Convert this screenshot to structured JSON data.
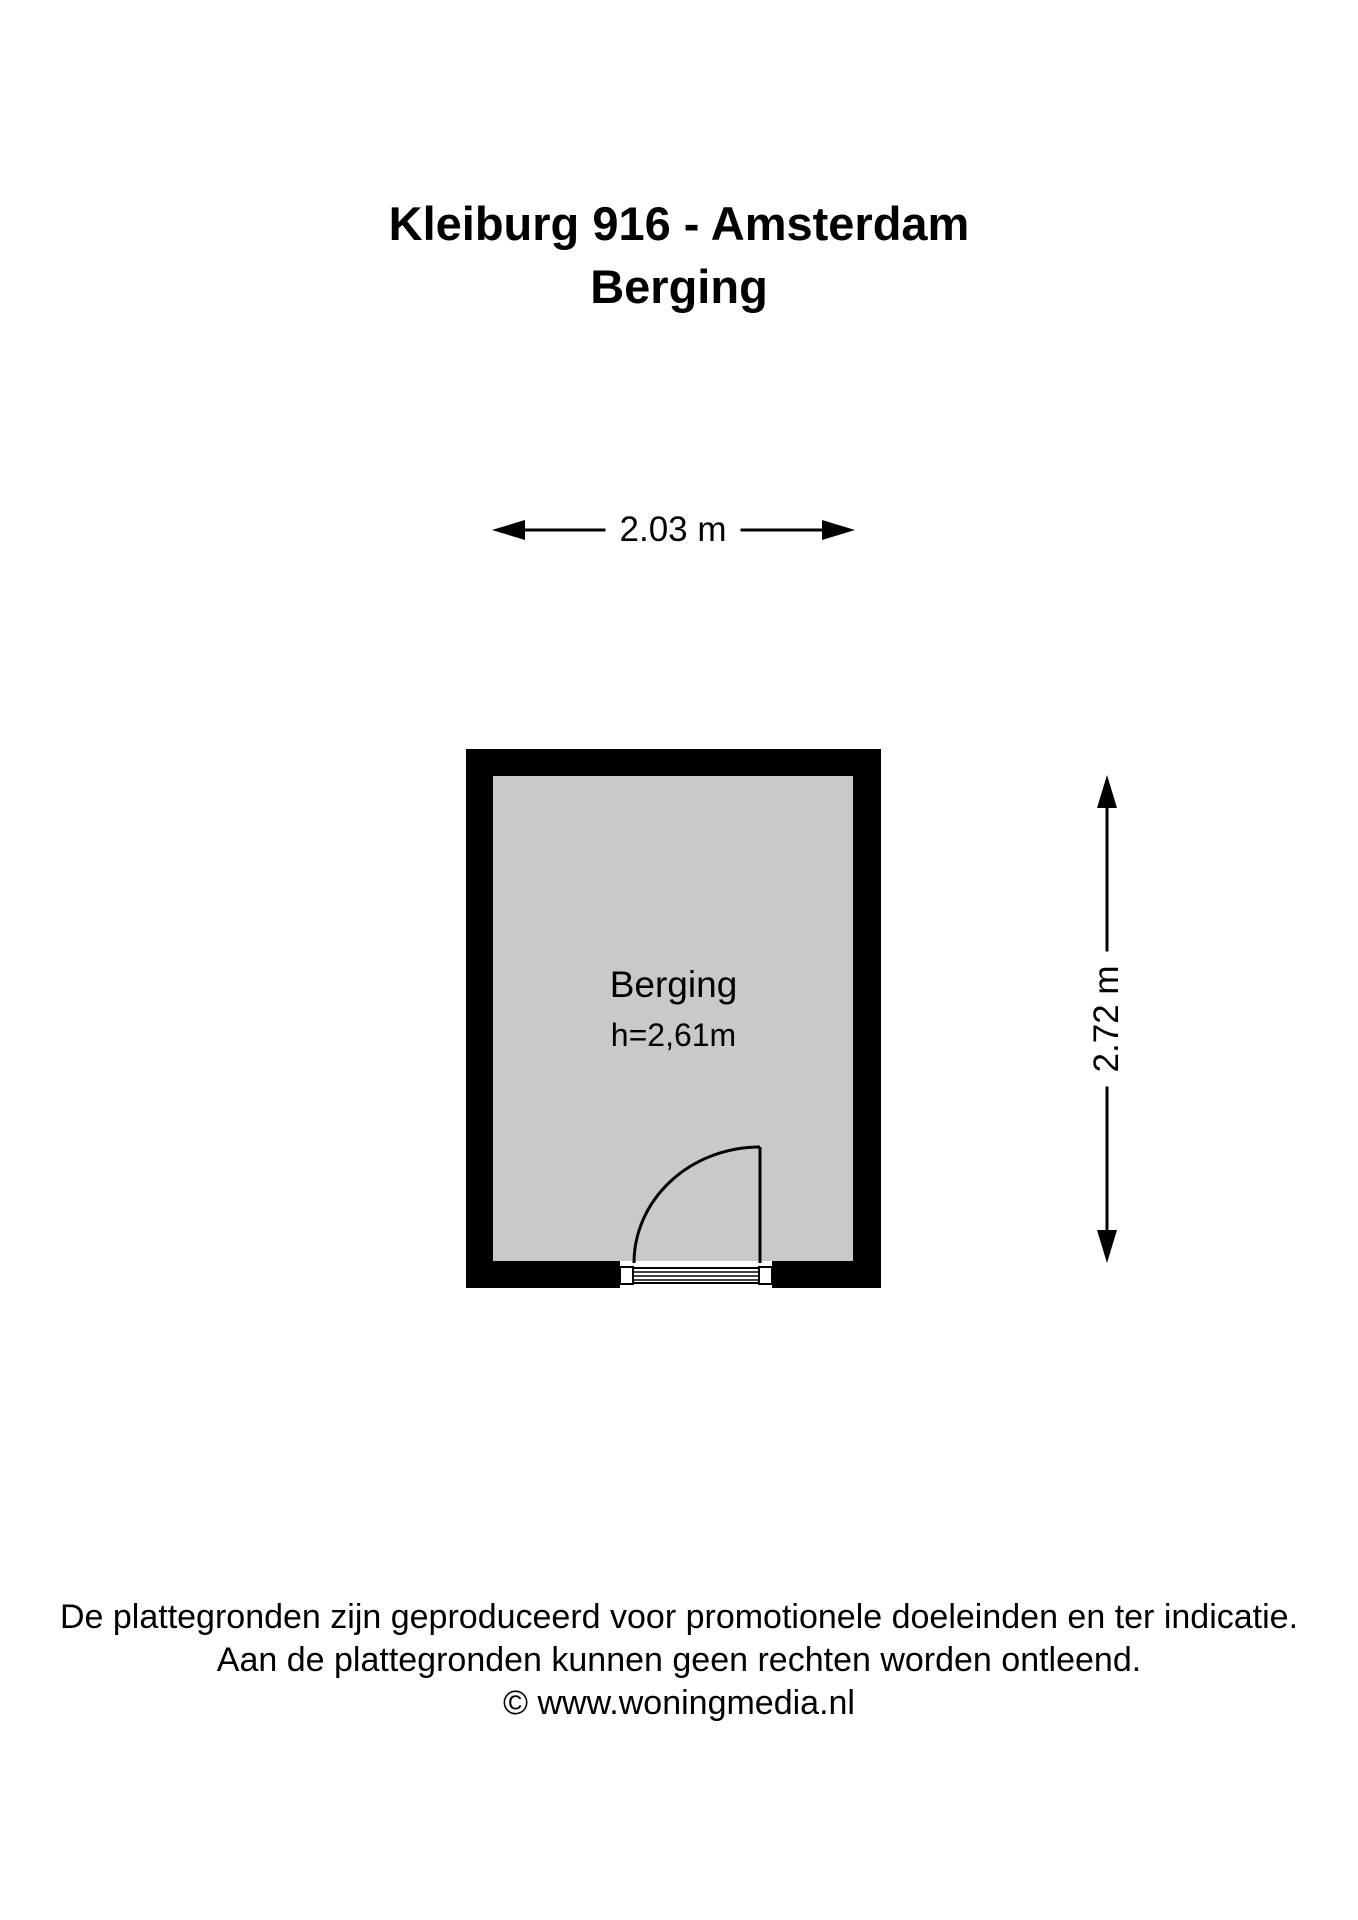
{
  "title": {
    "line1": "Kleiburg 916 - Amsterdam",
    "line2": "Berging"
  },
  "plan": {
    "room_label": "Berging",
    "room_height_label": "h=2,61m",
    "dim_width_label": "2.03 m",
    "dim_height_label": "2.72 m"
  },
  "footer": {
    "line1": "De plattegronden zijn geproduceerd voor promotionele doeleinden en ter indicatie.",
    "line2": "Aan de plattegronden kunnen geen rechten worden ontleend.",
    "line3": "© www.woningmedia.nl"
  },
  "colors": {
    "background": "#ffffff",
    "wall": "#000000",
    "floor": "#c9c9c9",
    "line": "#000000"
  }
}
